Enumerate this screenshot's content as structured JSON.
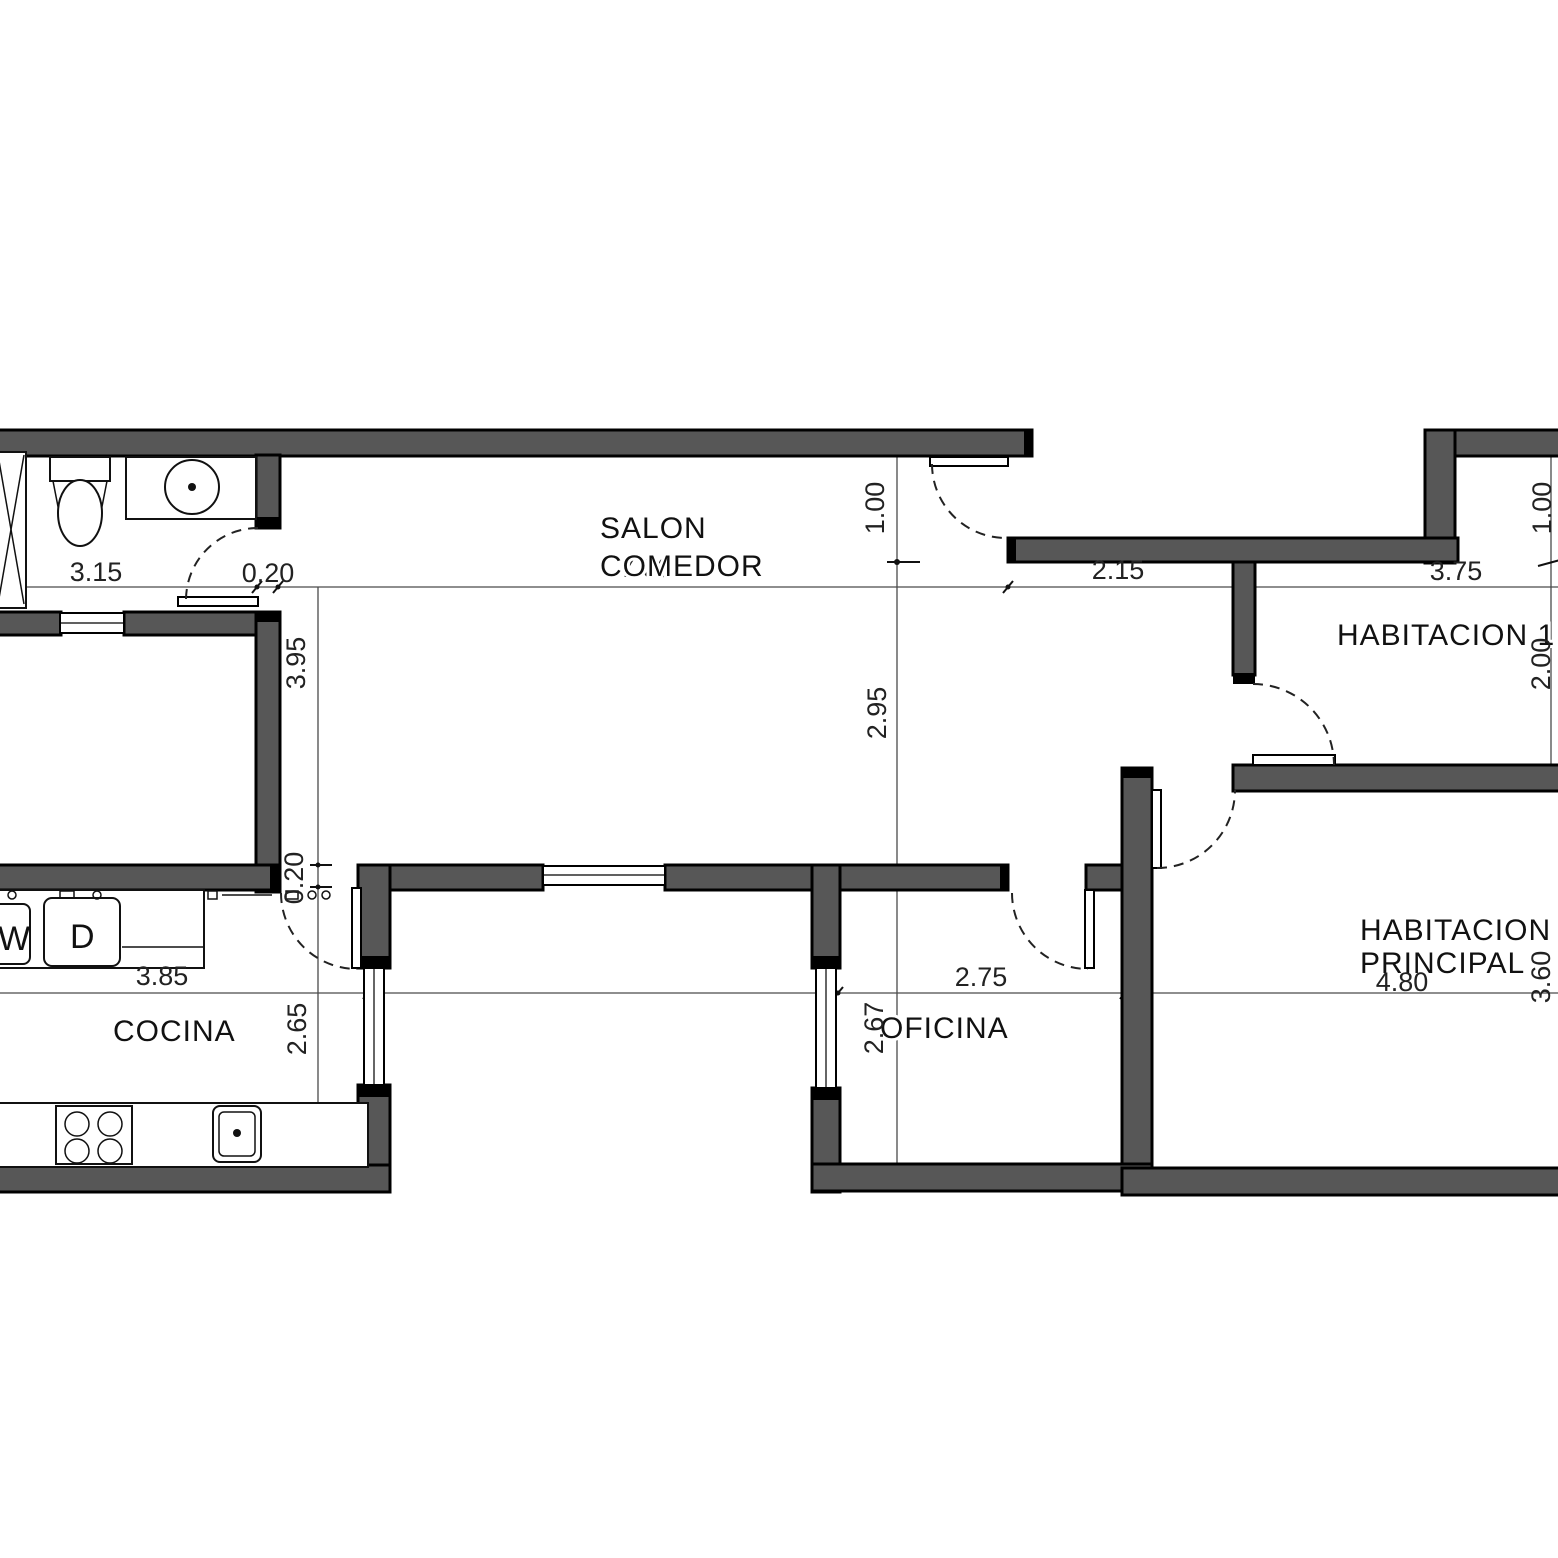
{
  "plan": {
    "title": "apartment-floor-plan",
    "rooms": [
      {
        "id": "salon-comedor",
        "line1": "SALON",
        "line2": "COMEDOR"
      },
      {
        "id": "habitacion-1",
        "label": "HABITACION 1"
      },
      {
        "id": "habitacion-principal",
        "line1": "HABITACION",
        "line2": "PRINCIPAL"
      },
      {
        "id": "cocina",
        "label": "COCINA"
      },
      {
        "id": "oficina",
        "label": "OFICINA"
      }
    ],
    "appliances": [
      {
        "id": "washer",
        "label": "W"
      },
      {
        "id": "dryer",
        "label": "D"
      }
    ],
    "dimensions": {
      "bath_width": "3.15",
      "wall_thickness_top": "0.20",
      "salon_width": "7.00",
      "entry_offset": "1.00",
      "salon_height": "2.95",
      "hall_width": "2.15",
      "hab1_width": "3.75",
      "hab1_notch": "1.00",
      "hab1_height": "2.00",
      "left_room_height": "3.95",
      "wall_thickness_mid": "0.20",
      "cocina_height": "2.65",
      "cocina_width": "3.85",
      "oficina_width": "2.75",
      "oficina_height": "2.67",
      "principal_width": "4.80",
      "principal_height": "3.60"
    },
    "colors": {
      "wall_fill": "#575757",
      "wall_outline": "#000000",
      "background": "#ffffff"
    }
  }
}
